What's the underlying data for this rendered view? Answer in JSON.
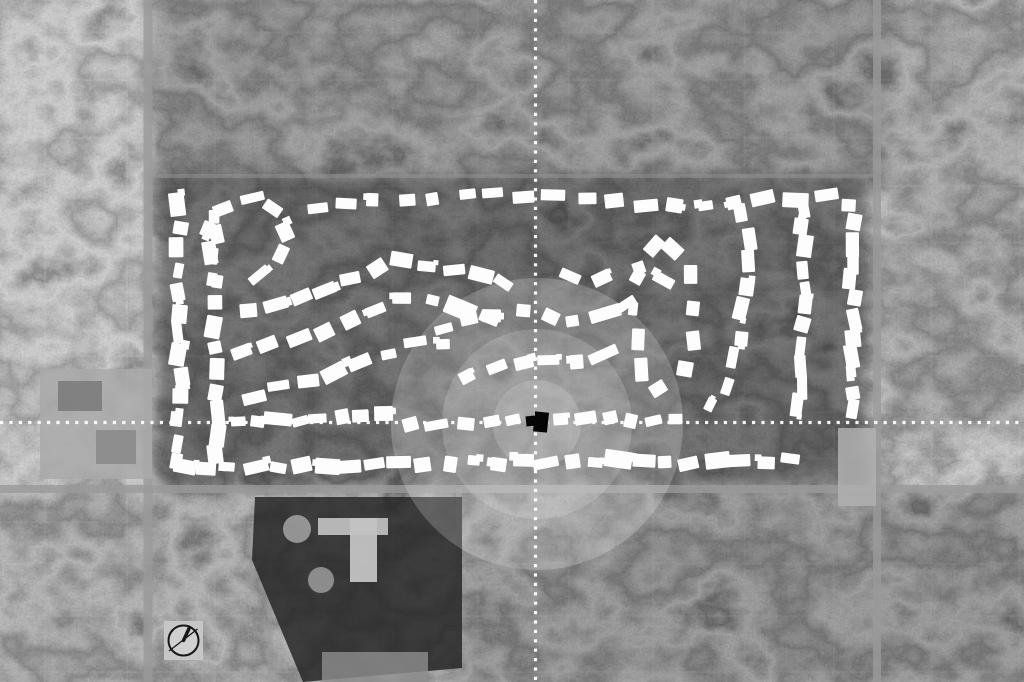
{
  "canvas": {
    "width": 1024,
    "height": 682,
    "description": "grayscale aerial map with highlighted subdivision homes"
  },
  "colors": {
    "base": "#4c4c4c",
    "house": "#fdfdfd",
    "marker": "#050505",
    "crosshair": "#ffffff",
    "road": "#9a9a9a",
    "glow": "#ffffff",
    "grid_line": "#d4d4d4"
  },
  "seed": 20,
  "crosshair": {
    "vertical_x": 535.5,
    "horizontal_y": 422.5,
    "dot_size": 3.2,
    "dot_gap": 6.2
  },
  "glow_rings": [
    {
      "cx": 537,
      "cy": 424,
      "r": 146,
      "opacity": 0.2
    },
    {
      "cx": 537,
      "cy": 424,
      "r": 95,
      "opacity": 0.16
    },
    {
      "cx": 537,
      "cy": 424,
      "r": 44,
      "opacity": 0.16
    }
  ],
  "center_marker": {
    "parts": [
      {
        "x": 526,
        "y": 416,
        "w": 9,
        "h": 10,
        "rot": -6
      },
      {
        "x": 534,
        "y": 412,
        "w": 14,
        "h": 20,
        "rot": 6
      }
    ]
  },
  "clock_icon": {
    "x": 164,
    "y": 621,
    "size": 39,
    "box_fill": "#c6c6c6",
    "face_cx": 183.5,
    "face_cy": 640.5,
    "face_r": 15,
    "face_fill": "#d0d0d0",
    "stroke": "#161616",
    "stroke_w": 2,
    "bold_hand": {
      "x2": 189.5,
      "y2": 627.5,
      "width": 3.4
    },
    "thin_hand": {
      "x1": 169,
      "y1": 651,
      "x2": 197.5,
      "y2": 629,
      "width": 1.3
    }
  },
  "grid": {
    "h_spacing": 54,
    "v_spacing": 88,
    "h_start": 28,
    "v_start": 44,
    "jitter": 9,
    "opacity": 0.15,
    "width": 2
  },
  "shades": [
    {
      "x": -10,
      "y": -10,
      "w": 165,
      "h": 500,
      "fill": "#ffffff",
      "opacity": 0.05
    },
    {
      "x": 150,
      "y": -20,
      "w": 740,
      "h": 205,
      "fill": "#000000",
      "opacity": 0.2
    },
    {
      "x": 156,
      "y": 176,
      "w": 712,
      "h": 312,
      "fill": "#000000",
      "opacity": 0.42
    },
    {
      "x": 462,
      "y": 490,
      "w": 575,
      "h": 200,
      "fill": "#000000",
      "opacity": 0.22
    },
    {
      "x": -10,
      "y": 490,
      "w": 472,
      "h": 200,
      "fill": "#000000",
      "opacity": 0.1
    },
    {
      "x": 884,
      "y": -10,
      "w": 150,
      "h": 445,
      "fill": "#000000",
      "opacity": 0.12
    }
  ],
  "roads": [
    {
      "orient": "v",
      "pos": 148,
      "width": 9,
      "from": 0,
      "to": 682,
      "opacity": 0.8
    },
    {
      "orient": "v",
      "pos": 877,
      "width": 8,
      "from": 0,
      "to": 682,
      "opacity": 0.8
    },
    {
      "orient": "h",
      "pos": 489,
      "width": 8,
      "from": 0,
      "to": 1024,
      "opacity": 0.8
    },
    {
      "orient": "h",
      "pos": 176,
      "width": 4,
      "from": 148,
      "to": 877,
      "opacity": 0.45
    },
    {
      "orient": "v",
      "pos": 459,
      "width": 6,
      "from": 489,
      "to": 682,
      "opacity": 0.6
    },
    {
      "orient": "v",
      "pos": 270,
      "width": 5,
      "from": 489,
      "to": 682,
      "opacity": 0.5
    }
  ],
  "landmarks": [
    {
      "shape": "rect",
      "name": "commercial-lot-west",
      "x": 40,
      "y": 369,
      "w": 112,
      "h": 110,
      "fill": "#a9a9a9",
      "opacity": 0.85
    },
    {
      "shape": "rect",
      "name": "commercial-building-west",
      "x": 58,
      "y": 381,
      "w": 44,
      "h": 30,
      "fill": "#7c7c7c",
      "opacity": 0.9
    },
    {
      "shape": "rect",
      "name": "commercial-building-west-2",
      "x": 96,
      "y": 430,
      "w": 40,
      "h": 34,
      "fill": "#8b8b8b",
      "opacity": 0.9
    },
    {
      "shape": "rect",
      "name": "strip-mall-east",
      "x": 838,
      "y": 428,
      "w": 38,
      "h": 78,
      "fill": "#b0b0b0",
      "opacity": 0.85
    },
    {
      "shape": "polygon",
      "name": "school-field",
      "points": "255,497 462,497 462,668 303,682 252,560",
      "fill": "#1f1f1f",
      "opacity": 0.8
    },
    {
      "shape": "rect",
      "name": "school-building-wing",
      "x": 318,
      "y": 518,
      "w": 70,
      "h": 17,
      "fill": "#bdbdbd",
      "opacity": 0.95
    },
    {
      "shape": "rect",
      "name": "school-building-main",
      "x": 350,
      "y": 518,
      "w": 27,
      "h": 64,
      "fill": "#c3c3c3",
      "opacity": 0.95
    },
    {
      "shape": "circle",
      "name": "ballfield-north",
      "cx": 297,
      "cy": 529,
      "r": 14,
      "fill": "#b3b3b3",
      "opacity": 0.75
    },
    {
      "shape": "circle",
      "name": "ballfield-south",
      "cx": 321,
      "cy": 580,
      "r": 13,
      "fill": "#a8a8a8",
      "opacity": 0.75
    },
    {
      "shape": "rect",
      "name": "building-south",
      "x": 322,
      "y": 652,
      "w": 106,
      "h": 30,
      "fill": "#8f8f8f",
      "opacity": 0.8
    }
  ],
  "house_style": {
    "fill": "#fdfdfd",
    "min_w": 12,
    "max_w": 25,
    "min_h": 9,
    "max_h": 16,
    "rot_jitter": 13,
    "pos_jitter": 3,
    "notch_chance": 0.3
  },
  "streets": [
    {
      "name": "west-column",
      "pts": [
        [
          179,
          194
        ],
        [
          179,
          474
        ]
      ],
      "count": 13
    },
    {
      "name": "west-column-2",
      "pts": [
        [
          214,
          203
        ],
        [
          216,
          468
        ]
      ],
      "count": 12
    },
    {
      "name": "northwest-loop",
      "pts": [
        [
          210,
          295
        ],
        [
          207,
          235
        ],
        [
          221,
          208
        ],
        [
          250,
          198
        ],
        [
          278,
          211
        ],
        [
          289,
          238
        ],
        [
          276,
          265
        ],
        [
          249,
          279
        ]
      ],
      "count": 9
    },
    {
      "name": "west-arc-1",
      "pts": [
        [
          237,
          314
        ],
        [
          320,
          294
        ],
        [
          398,
          262
        ],
        [
          462,
          268
        ],
        [
          516,
          289
        ]
      ],
      "count": 11
    },
    {
      "name": "west-arc-2",
      "pts": [
        [
          229,
          357
        ],
        [
          318,
          332
        ],
        [
          402,
          300
        ],
        [
          458,
          306
        ],
        [
          500,
          320
        ]
      ],
      "count": 10
    },
    {
      "name": "west-arc-3",
      "pts": [
        [
          241,
          400
        ],
        [
          331,
          374
        ],
        [
          414,
          342
        ],
        [
          455,
          346
        ]
      ],
      "count": 8
    },
    {
      "name": "west-row-mid",
      "pts": [
        [
          225,
          424
        ],
        [
          392,
          414
        ]
      ],
      "count": 8
    },
    {
      "name": "south-row",
      "pts": [
        [
          170,
          469
        ],
        [
          480,
          463
        ],
        [
          800,
          461
        ]
      ],
      "count": 26
    },
    {
      "name": "north-row",
      "pts": [
        [
          300,
          209
        ],
        [
          430,
          197
        ],
        [
          560,
          194
        ],
        [
          640,
          203
        ],
        [
          700,
          207
        ],
        [
          840,
          193
        ]
      ],
      "count": 18
    },
    {
      "name": "north-arc",
      "pts": [
        [
          428,
          334
        ],
        [
          470,
          319
        ],
        [
          515,
          311
        ],
        [
          558,
          321
        ],
        [
          600,
          317
        ],
        [
          640,
          299
        ]
      ],
      "count": 8
    },
    {
      "name": "inner-arc",
      "pts": [
        [
          455,
          382
        ],
        [
          497,
          369
        ],
        [
          540,
          363
        ],
        [
          582,
          359
        ],
        [
          620,
          351
        ]
      ],
      "count": 6
    },
    {
      "name": "center-row-west",
      "pts": [
        [
          400,
          425
        ],
        [
          527,
          418
        ]
      ],
      "count": 5
    },
    {
      "name": "center-row-east",
      "pts": [
        [
          551,
          421
        ],
        [
          690,
          420
        ]
      ],
      "count": 6
    },
    {
      "name": "east-loop",
      "pts": [
        [
          664,
          235
        ],
        [
          686,
          258
        ],
        [
          694,
          300
        ],
        [
          692,
          345
        ],
        [
          678,
          380
        ],
        [
          658,
          393
        ],
        [
          640,
          372
        ],
        [
          634,
          330
        ],
        [
          636,
          285
        ],
        [
          648,
          250
        ],
        [
          664,
          235
        ]
      ],
      "count": 11
    },
    {
      "name": "east-chain",
      "pts": [
        [
          737,
          201
        ],
        [
          752,
          241
        ],
        [
          746,
          291
        ],
        [
          738,
          341
        ],
        [
          727,
          386
        ],
        [
          706,
          416
        ]
      ],
      "count": 9
    },
    {
      "name": "east-column-inner",
      "pts": [
        [
          801,
          200
        ],
        [
          806,
          300
        ],
        [
          798,
          414
        ]
      ],
      "count": 11
    },
    {
      "name": "east-column-edge",
      "pts": [
        [
          851,
          197
        ],
        [
          854,
          420
        ]
      ],
      "count": 12
    },
    {
      "name": "mid-scatter",
      "pts": [
        [
          556,
          271
        ],
        [
          600,
          280
        ],
        [
          648,
          267
        ],
        [
          676,
          291
        ]
      ],
      "count": 4
    }
  ]
}
